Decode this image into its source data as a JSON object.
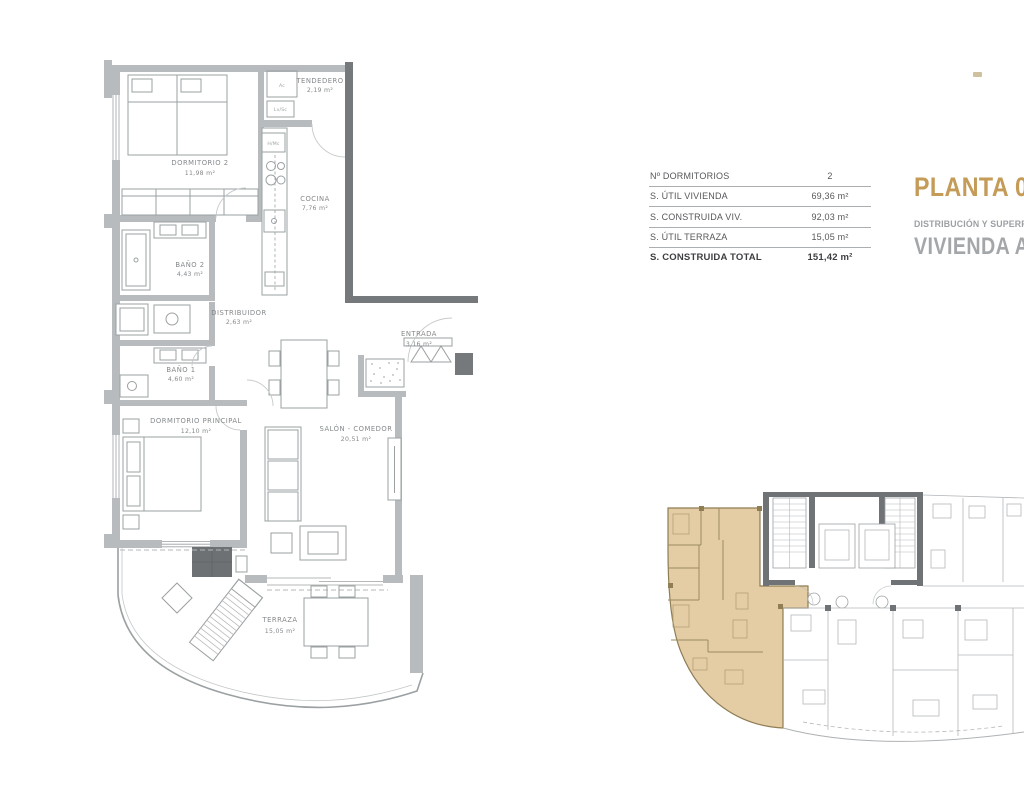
{
  "header": {
    "plan_title": "PLANTA 02",
    "subtitle": "DISTRIBUCIÓN Y SUPERFICIES",
    "unit_title": "VIVIENDA A",
    "accent_color": "#c49b57",
    "muted_color": "#a4a7aa"
  },
  "summary_table": {
    "rows": [
      {
        "label": "Nº DORMITORIOS",
        "value": "2"
      },
      {
        "label": "S. ÚTIL VIVIENDA",
        "value": "69,36 m²"
      },
      {
        "label": "S. CONSTRUIDA VIV.",
        "value": "92,03 m²"
      },
      {
        "label": "S. ÚTIL TERRAZA",
        "value": "15,05 m²"
      },
      {
        "label": "S. CONSTRUIDA TOTAL",
        "value": "151,42 m²"
      }
    ]
  },
  "floor_plan": {
    "rooms": [
      {
        "name": "DORMITORIO 2",
        "area": "11,98 m²"
      },
      {
        "name": "TENDEDERO",
        "area": "2,19 m²"
      },
      {
        "name": "COCINA",
        "area": "7,76 m²"
      },
      {
        "name": "BAÑO 2",
        "area": "4,43 m²"
      },
      {
        "name": "DISTRIBUIDOR",
        "area": "2,63 m²"
      },
      {
        "name": "BAÑO 1",
        "area": "4,60 m²"
      },
      {
        "name": "ENTRADA",
        "area": "3,16 m²"
      },
      {
        "name": "DORMITORIO PRINCIPAL",
        "area": "12,10 m²"
      },
      {
        "name": "SALÓN - COMEDOR",
        "area": "20,51 m²"
      },
      {
        "name": "TERRAZA",
        "area": "15,05 m²"
      }
    ],
    "appliances": {
      "ac": "Ac",
      "lv_sc": "Lv/Sc",
      "h_mc": "H/Mc"
    },
    "wall_color": "#b7bbbe",
    "dark_wall_color": "#75797c",
    "line_color": "#9ba0a3",
    "label_color": "#85898c"
  },
  "key_plan": {
    "highlight_fill": "#e4cda5",
    "highlight_stroke": "#8f7d54",
    "line_color": "#b3b7ba",
    "core_color": "#6f7376"
  }
}
